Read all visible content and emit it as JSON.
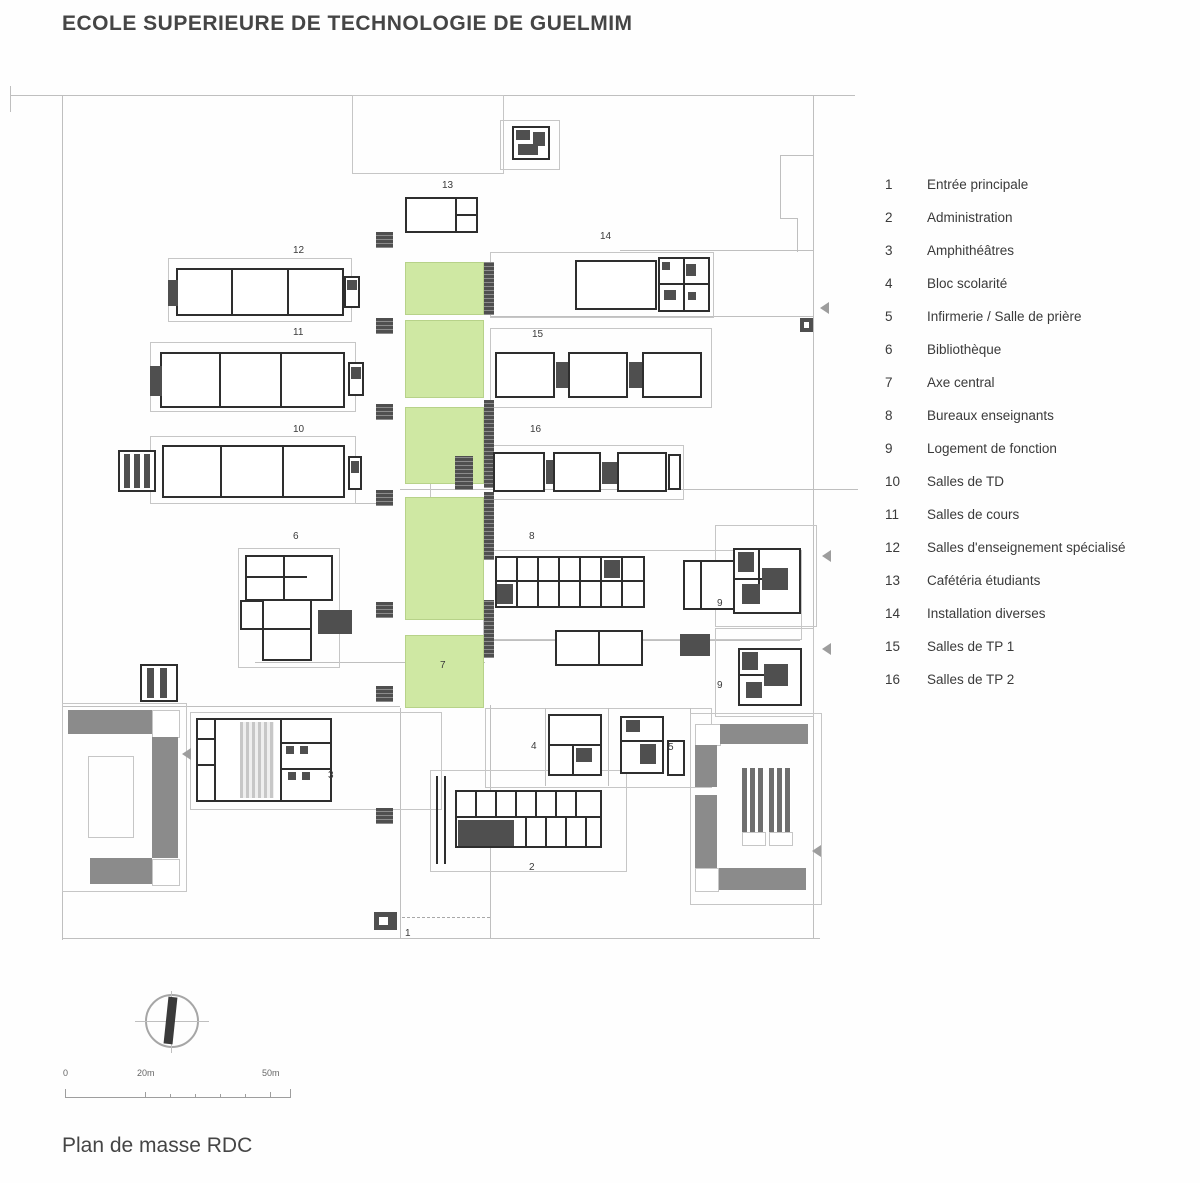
{
  "title": "ECOLE SUPERIEURE DE TECHNOLOGIE DE GUELMIM",
  "caption": "Plan de masse RDC",
  "legend": {
    "items": [
      {
        "num": "1",
        "label": "Entrée principale"
      },
      {
        "num": "2",
        "label": "Administration"
      },
      {
        "num": "3",
        "label": "Amphithéâtres"
      },
      {
        "num": "4",
        "label": "Bloc scolarité"
      },
      {
        "num": "5",
        "label": "Infirmerie / Salle de prière"
      },
      {
        "num": "6",
        "label": "Bibliothèque"
      },
      {
        "num": "7",
        "label": "Axe central"
      },
      {
        "num": "8",
        "label": "Bureaux enseignants"
      },
      {
        "num": "9",
        "label": "Logement de fonction"
      },
      {
        "num": "10",
        "label": "Salles de TD"
      },
      {
        "num": "11",
        "label": "Salles de cours"
      },
      {
        "num": "12",
        "label": "Salles d'enseignement spécialisé"
      },
      {
        "num": "13",
        "label": "Cafétéria étudiants"
      },
      {
        "num": "14",
        "label": "Installation diverses"
      },
      {
        "num": "15",
        "label": "Salles de TP 1"
      },
      {
        "num": "16",
        "label": "Salles de TP 2"
      }
    ]
  },
  "scalebar": {
    "zero": "0",
    "mid": "20m",
    "end": "50m"
  },
  "plan_labels": {
    "b1": "1",
    "b2": "2",
    "b3": "3",
    "b4": "4",
    "b5": "5",
    "b6": "6",
    "b7": "7",
    "b8": "8",
    "b9a": "9",
    "b9b": "9",
    "b10": "10",
    "b11": "11",
    "b12": "12",
    "b13": "13",
    "b14": "14",
    "b15": "15",
    "b16": "16"
  },
  "colors": {
    "axis_green": "#cfe8a3",
    "dark_fill": "#4f4f4f",
    "structure_gray": "#8b8b8b",
    "line_gray": "#bfbfbf",
    "ink": "#2e2e2e"
  }
}
